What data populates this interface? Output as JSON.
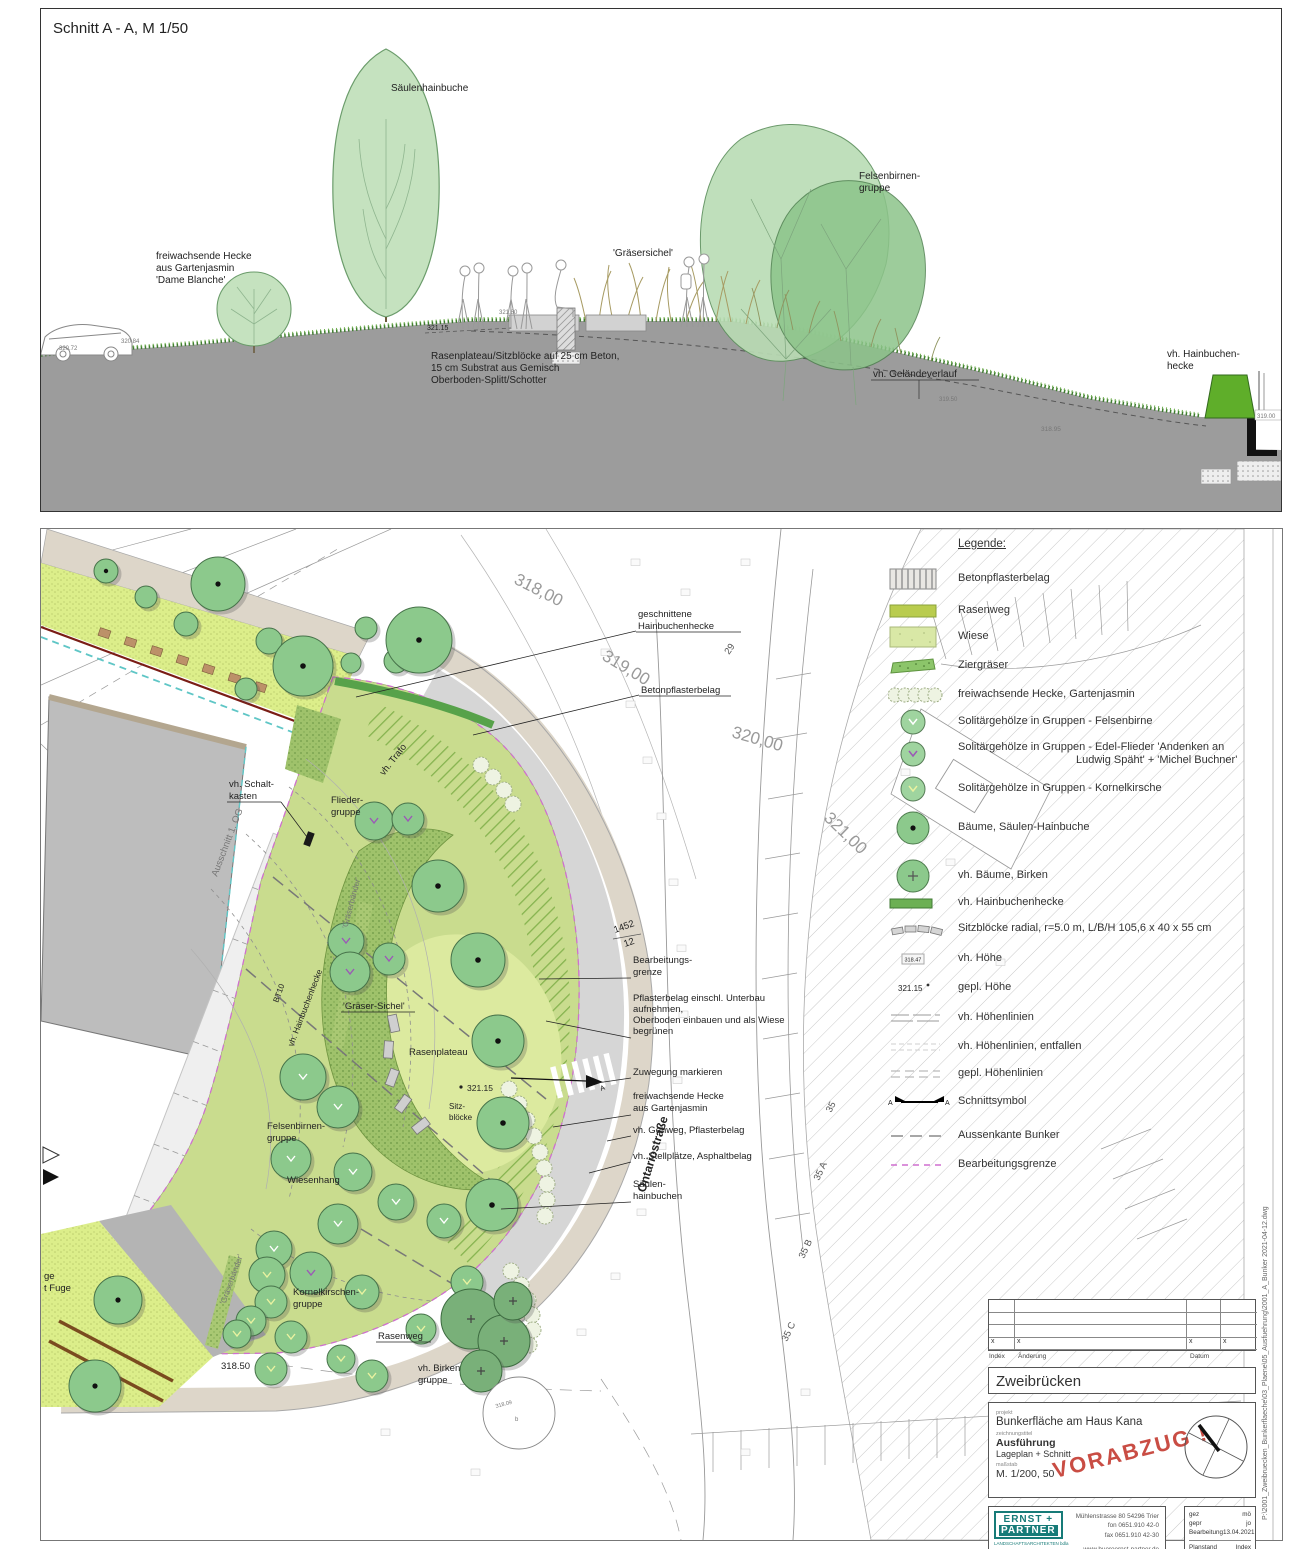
{
  "section": {
    "title": "Schnitt  A - A, M 1/50",
    "labels": {
      "tree": "Säulenhainbuche",
      "hedge1": "freiwachsende Hecke",
      "hedge2": "aus Gartenjasmin",
      "hedge3": "'Dame Blanche'",
      "grasses": "'Gräsersichel'",
      "felsen1": "Felsenbirnen-",
      "felsen2": "gruppe",
      "plateau1": "Rasenplateau/Sitzblöcke auf 25 cm Beton,",
      "plateau2": "15 cm Substrat aus Gemisch",
      "plateau3": "Oberboden-Splitt/Schotter",
      "terrain": "vh. Geländeverlauf",
      "hb1": "vh. Hainbuchen-",
      "hb2": "hecke"
    },
    "elev": {
      "e1": "320.72",
      "e2": "320.84",
      "e3": "321.15",
      "e4": "321.80",
      "e5": "319.50",
      "e6": "318.95",
      "e7": "319.00"
    }
  },
  "plan": {
    "labels": {
      "gh1": "geschnittene",
      "gh2": "Hainbuchenhecke",
      "bp": "Betonpflasterbelag",
      "sk1": "vh. Schalt-",
      "sk2": "kasten",
      "trafo": "vh. Trafo",
      "ausschnitt": "Ausschnitt 1. OG",
      "vhhb": "vh. Hainbuchenhecke",
      "gb1": "'Gräserbänder'",
      "gb2": "'Gräserbänder'",
      "fl1": "Flieder-",
      "fl2": "gruppe",
      "gs": "'Gräser-Sichel'",
      "rp": "Rasenplateau",
      "h321": "321.15",
      "sb1": "Sitz-",
      "sb2": "blöcke",
      "fb1": "Felsenbirnen-",
      "fb2": "gruppe",
      "wh": "Wiesenhang",
      "kk1": "Kornelkirschen-",
      "kk2": "gruppe",
      "rw": "Rasenweg",
      "bi1": "vh. Birken",
      "bi2": "gruppe",
      "h318": "318.50",
      "bg1": "Bearbeitungs-",
      "bg2": "grenze",
      "pf1": "Pflasterbelag einschl. Unterbau",
      "pf2": "aufnehmen,",
      "pf3": "Oberboden einbauen und als Wiese",
      "pf4": "begrünen",
      "zw": "Zuwegung markieren",
      "fw1": "freiwachsende Hecke",
      "fw2": "aus Gartenjasmin",
      "gw": "vh. Gehweg, Pflasterbelag",
      "sp": "vh. Stellplätze, Asphaltbelag",
      "sh1": "Säulen-",
      "sh2": "hainbuchen",
      "os": "Ontariostraße",
      "bt": "BT10",
      "fr1": "ge",
      "fr2": "t Fuge",
      "tn1": "318.09",
      "tn2": "b"
    },
    "contours": {
      "c1": "318,00",
      "c2": "319,00",
      "c3": "320,00",
      "c4": "321,00"
    },
    "parcels": {
      "p29": "29",
      "p35": "35",
      "p35a": "35 A",
      "p35b": "35 B",
      "p35c": "35 C",
      "p1452a": "1452",
      "p1452b": "12"
    },
    "marker_a": "A"
  },
  "legend": {
    "title": "Legende:",
    "sym_vh": "318.47",
    "sym_gepl": "321.15",
    "sym_a": "A",
    "items": [
      {
        "label": "Betonpflasterbelag"
      },
      {
        "label": "Rasenweg"
      },
      {
        "label": "Wiese"
      },
      {
        "label": "Ziergräser"
      },
      {
        "label": "freiwachsende Hecke, Gartenjasmin"
      },
      {
        "label": "Solitärgehölze in Gruppen - Felsenbirne"
      },
      {
        "label": "Solitärgehölze in Gruppen - Edel-Flieder 'Andenken an",
        "label2": "Ludwig Späht' + 'Michel Buchner'"
      },
      {
        "label": "Solitärgehölze in Gruppen - Kornelkirsche"
      },
      {
        "label": "Bäume, Säulen-Hainbuche"
      },
      {
        "label": "vh. Bäume, Birken"
      },
      {
        "label": "vh. Hainbuchenhecke"
      },
      {
        "label": "Sitzblöcke radial, r=5.0 m, L/B/H 105,6 x 40 x 55 cm"
      },
      {
        "label": "vh. Höhe"
      },
      {
        "label": "gepl. Höhe"
      },
      {
        "label": "vh. Höhenlinien"
      },
      {
        "label": "vh. Höhenlinien, entfallen"
      },
      {
        "label": "gepl. Höhenlinien"
      },
      {
        "label": "Schnittsymbol"
      },
      {
        "label": "Aussenkante Bunker"
      },
      {
        "label": "Bearbeitungsgrenze"
      }
    ]
  },
  "title_block": {
    "index_x": "x",
    "index_label": "Index",
    "aenderung_label": "Änderung",
    "datum_label": "Datum",
    "city": "Zweibrücken",
    "project_label": "projekt",
    "project": "Bunkerfläche am Haus Kana",
    "drawing_label": "zeichnungstitel",
    "drawing_title": "Ausführung",
    "drawing_sub": "Lageplan + Schnitt",
    "scale_label": "maßstab",
    "scale": "M. 1/200, 50",
    "stamp": "VORABZUG !",
    "firm_name1": "ERNST +",
    "firm_name2": "PARTNER",
    "firm_sub": "LANDSCHAFTSARCHITEKTEN bdla",
    "address1": "Mühlenstrasse 80  54296 Trier",
    "address2": "fon   0651.910 42-0",
    "address3": "fax   0651.910 42-30",
    "web": "www.bueroernst-partner.de",
    "email": "email@bueroernst-partner.de",
    "gez_label": "gez",
    "gez": "mö",
    "gepr_label": "gepr",
    "gepr": "jo",
    "bearb_label": "Bearbeitung",
    "bearb": "13.04.2021",
    "planstand_label": "Planstand",
    "planstand": "Index",
    "plannr_label": "Plan-NR",
    "plannr": "2001-A",
    "side_text": "P:\\2001_Zweibruecken_Bunkerflaeche\\03_Plaene\\05_Ausfuehrung\\2001_A_Bunker 2021-04-12.dwg"
  }
}
